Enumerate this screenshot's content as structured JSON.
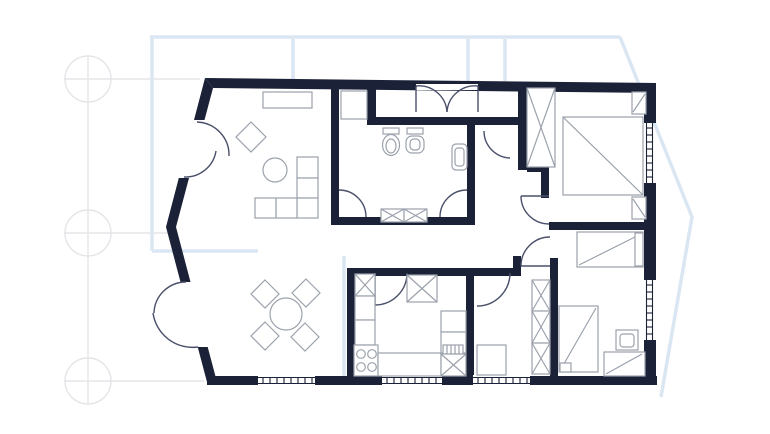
{
  "meta": {
    "type": "floor-plan",
    "description": "apartment blueprint floor plan"
  },
  "colors": {
    "background": "#ffffff",
    "wall": "#1b2137",
    "blueprint": "#dbe6f3",
    "grid": "#e4e5e8",
    "furniture": "#9ba2ac",
    "door": "#4a506a",
    "opening": "#ffffff"
  },
  "layers": {
    "blueprint": [
      {
        "name": "blueprint-outline-top",
        "type": "path",
        "d": "M150,37 H620"
      },
      {
        "name": "blueprint-outline-right-chevron",
        "type": "path",
        "d": "M620,37 L692,217 L661,397"
      },
      {
        "name": "blueprint-outline-left",
        "type": "path",
        "d": "M152,37 V251"
      },
      {
        "name": "blueprint-outline-left-branch",
        "type": "path",
        "d": "M152,251 H258"
      },
      {
        "name": "blueprint-stub-line",
        "type": "path",
        "d": "M293,39 V80"
      },
      {
        "name": "blueprint-stub-line",
        "type": "path",
        "d": "M468,39 V81"
      },
      {
        "name": "blueprint-stub-line",
        "type": "path",
        "d": "M505,39 V81"
      },
      {
        "name": "blueprint-inner-line",
        "type": "path",
        "d": "M344,256 V376"
      }
    ],
    "grid": [
      {
        "name": "grid-marker-circle",
        "type": "circle",
        "cx": 88,
        "cy": 79,
        "r": 23
      },
      {
        "name": "grid-marker-circle",
        "type": "circle",
        "cx": 88,
        "cy": 233,
        "r": 23
      },
      {
        "name": "grid-marker-circle",
        "type": "circle",
        "cx": 88,
        "cy": 381,
        "r": 23
      },
      {
        "name": "grid-axis-vertical",
        "type": "line",
        "x1": 88,
        "y1": 56,
        "x2": 88,
        "y2": 404
      },
      {
        "name": "grid-axis-horizontal",
        "type": "line",
        "x1": 64,
        "y1": 79,
        "x2": 200,
        "y2": 79
      },
      {
        "name": "grid-axis-horizontal",
        "type": "line",
        "x1": 64,
        "y1": 233,
        "x2": 172,
        "y2": 233
      },
      {
        "name": "grid-axis-horizontal",
        "type": "line",
        "x1": 64,
        "y1": 381,
        "x2": 204,
        "y2": 381
      }
    ],
    "walls": [
      {
        "name": "wall-top",
        "type": "poly",
        "points": "205,78 656,83 656,93 213,88"
      },
      {
        "name": "wall-left-upper-a",
        "type": "poly",
        "points": "205,78 213,88 204.5,120 194,120"
      },
      {
        "name": "wall-left-upper-b",
        "type": "poly",
        "points": "178.8,178 189,178 176,227 166,227"
      },
      {
        "name": "wall-left-lower-a",
        "type": "poly",
        "points": "166,227 176,227 190.5,282 180.5,282"
      },
      {
        "name": "wall-left-lower-b",
        "type": "poly",
        "points": "197.7,347 207.7,347 217,382 207,382"
      },
      {
        "name": "wall-bottom",
        "type": "rect",
        "x": 207,
        "y": 376,
        "w": 450,
        "h": 9
      },
      {
        "name": "wall-right-a",
        "type": "rect",
        "x": 644,
        "y": 83,
        "w": 12,
        "h": 40
      },
      {
        "name": "wall-right-b",
        "type": "rect",
        "x": 644,
        "y": 183,
        "w": 12,
        "h": 97
      },
      {
        "name": "wall-right-c",
        "type": "rect",
        "x": 644,
        "y": 340,
        "w": 12,
        "h": 45
      },
      {
        "name": "wall-bath-left",
        "type": "rect",
        "x": 331,
        "y": 86,
        "w": 8,
        "h": 139
      },
      {
        "name": "wall-entry-stub",
        "type": "rect",
        "x": 367,
        "y": 86,
        "w": 9,
        "h": 35
      },
      {
        "name": "wall-closet-bottom",
        "type": "rect",
        "x": 367,
        "y": 117,
        "w": 151,
        "h": 8
      },
      {
        "name": "wall-bath-right",
        "type": "rect",
        "x": 467,
        "y": 125,
        "w": 8,
        "h": 100
      },
      {
        "name": "wall-bath-bottom",
        "type": "rect",
        "x": 331,
        "y": 217,
        "w": 144,
        "h": 8
      },
      {
        "name": "wall-master-left",
        "type": "rect",
        "x": 518,
        "y": 82,
        "w": 9,
        "h": 88
      },
      {
        "name": "wall-master-jog",
        "type": "rect",
        "x": 527,
        "y": 163,
        "w": 22,
        "h": 9
      },
      {
        "name": "wall-master-door-post",
        "type": "rect",
        "x": 541,
        "y": 172,
        "w": 8,
        "h": 26
      },
      {
        "name": "wall-master-south",
        "type": "rect",
        "x": 549,
        "y": 222,
        "w": 107,
        "h": 8
      },
      {
        "name": "wall-bedroom-left",
        "type": "rect",
        "x": 550,
        "y": 258,
        "w": 8,
        "h": 124
      },
      {
        "name": "wall-hall-stub",
        "type": "rect",
        "x": 513,
        "y": 256,
        "w": 8,
        "h": 20
      },
      {
        "name": "wall-midroom-top",
        "type": "rect",
        "x": 474,
        "y": 268,
        "w": 39,
        "h": 8
      },
      {
        "name": "wall-kitchen-top",
        "type": "rect",
        "x": 347,
        "y": 268,
        "w": 119,
        "h": 8
      },
      {
        "name": "wall-kitchen-left",
        "type": "rect",
        "x": 347,
        "y": 268,
        "w": 8,
        "h": 110
      },
      {
        "name": "wall-kitchen-right",
        "type": "rect",
        "x": 466,
        "y": 268,
        "w": 8,
        "h": 110
      }
    ],
    "openings": [
      {
        "name": "door-opening",
        "type": "rect",
        "x": 416,
        "y": 84,
        "w": 62,
        "h": 6
      },
      {
        "name": "window-opening",
        "type": "rect",
        "x": 258,
        "y": 375,
        "w": 57,
        "h": 11
      },
      {
        "name": "window-opening",
        "type": "rect",
        "x": 382,
        "y": 375,
        "w": 60,
        "h": 11
      },
      {
        "name": "window-opening",
        "type": "rect",
        "x": 473,
        "y": 375,
        "w": 57,
        "h": 11
      }
    ],
    "windows": [
      {
        "name": "window",
        "orient": "h",
        "from": 258,
        "to": 315,
        "l1": 377.5,
        "l2": 383.5
      },
      {
        "name": "window",
        "orient": "h",
        "from": 382,
        "to": 442,
        "l1": 377.5,
        "l2": 383.5
      },
      {
        "name": "window",
        "orient": "h",
        "from": 473,
        "to": 530,
        "l1": 377.5,
        "l2": 383.5
      },
      {
        "name": "window",
        "orient": "v",
        "from": 123,
        "to": 183,
        "l1": 646.5,
        "l2": 652.5
      },
      {
        "name": "window",
        "orient": "v",
        "from": 280,
        "to": 340,
        "l1": 646.5,
        "l2": 652.5
      }
    ],
    "doors": [
      {
        "name": "closet-door-leaf",
        "type": "line",
        "x1": 416,
        "y1": 86,
        "x2": 416,
        "y2": 112
      },
      {
        "name": "closet-door-leaf",
        "type": "line",
        "x1": 478,
        "y1": 86,
        "x2": 478,
        "y2": 112
      },
      {
        "name": "closet-door-swing",
        "type": "path",
        "d": "M416,86 A28,28 0 0 1 447,112"
      },
      {
        "name": "closet-door-swing",
        "type": "path",
        "d": "M478,86 A28,28 0 0 0 447,112"
      },
      {
        "name": "balcony-door-swing",
        "type": "path",
        "d": "M197,122 A33,33 0 0 1 229,156"
      },
      {
        "name": "balcony-door-swing",
        "type": "path",
        "d": "M184,177 A31,31 0 0 0 216,151"
      },
      {
        "name": "terrace-door-swing",
        "type": "path",
        "d": "M186,282 A32,32 0 0 0 154,313"
      },
      {
        "name": "terrace-door-swing",
        "type": "path",
        "d": "M198,347 A40,40 0 0 1 153,313"
      },
      {
        "name": "bathroom-door-swing",
        "type": "path",
        "d": "M339,190 A27,27 0 0 1 366,217"
      },
      {
        "name": "bathroom-door-swing",
        "type": "path",
        "d": "M440,217 A27,27 0 0 1 467,190"
      },
      {
        "name": "hall-door-swing",
        "type": "path",
        "d": "M484,131 A27,27 0 0 0 510,158"
      },
      {
        "name": "master-door-leaf",
        "type": "line",
        "x1": 521,
        "y1": 196,
        "x2": 549,
        "y2": 196
      },
      {
        "name": "master-door-swing",
        "type": "path",
        "d": "M521,196 A28,28 0 0 0 549,224"
      },
      {
        "name": "bedroom-door-leaf",
        "type": "line",
        "x1": 521,
        "y1": 266,
        "x2": 550,
        "y2": 266
      },
      {
        "name": "bedroom-door-swing",
        "type": "path",
        "d": "M521,266 A29,29 0 0 1 550,237"
      },
      {
        "name": "midroom-door-swing",
        "type": "path",
        "d": "M510,273 A33,33 0 0 1 477,306"
      },
      {
        "name": "kitchen-door-leaf",
        "type": "line",
        "x1": 375,
        "y1": 273,
        "x2": 375,
        "y2": 305
      },
      {
        "name": "kitchen-door-swing",
        "type": "path",
        "d": "M375,305 A32,32 0 0 0 407,273"
      }
    ],
    "furniture": [
      {
        "name": "sideboard",
        "type": "rect",
        "x": 263,
        "y": 92,
        "w": 49,
        "h": 16
      },
      {
        "name": "armchair",
        "type": "poly",
        "points": "251,122 266,137 251,152 236,137"
      },
      {
        "name": "side-table",
        "type": "circle",
        "cx": 275,
        "cy": 170,
        "r": 12
      },
      {
        "name": "sofa-seat",
        "type": "rect",
        "x": 297,
        "y": 157,
        "w": 21,
        "h": 21
      },
      {
        "name": "sofa-seat",
        "type": "rect",
        "x": 297,
        "y": 178,
        "w": 21,
        "h": 20
      },
      {
        "name": "sofa-seat",
        "type": "rect",
        "x": 297,
        "y": 198,
        "w": 21,
        "h": 20
      },
      {
        "name": "sofa-seat",
        "type": "rect",
        "x": 276,
        "y": 198,
        "w": 21,
        "h": 20
      },
      {
        "name": "sofa-seat",
        "type": "rect",
        "x": 255,
        "y": 198,
        "w": 21,
        "h": 20
      },
      {
        "name": "dining-table",
        "type": "circle",
        "cx": 286,
        "cy": 314,
        "r": 16
      },
      {
        "name": "dining-chair",
        "type": "poly",
        "points": "265,280 279,294 265,308 251,294"
      },
      {
        "name": "dining-chair",
        "type": "poly",
        "points": "306,279 320,293 306,307 292,293"
      },
      {
        "name": "dining-chair",
        "type": "poly",
        "points": "265,322 279,336 265,350 251,336"
      },
      {
        "name": "dining-chair",
        "type": "poly",
        "points": "305,323 319,337 305,351 291,337"
      },
      {
        "name": "washing-machine",
        "type": "rect",
        "x": 341,
        "y": 91,
        "w": 26,
        "h": 28
      },
      {
        "name": "toilet-tank",
        "type": "rect",
        "x": 383,
        "y": 128,
        "w": 16,
        "h": 6
      },
      {
        "name": "toilet-bowl",
        "type": "ellipse",
        "cx": 391,
        "cy": 145,
        "rx": 8.5,
        "ry": 10.5
      },
      {
        "name": "toilet-bowl-inner",
        "type": "ellipse",
        "cx": 391,
        "cy": 146,
        "rx": 5,
        "ry": 7
      },
      {
        "name": "bidet-tank",
        "type": "rect",
        "x": 407,
        "y": 128,
        "w": 16,
        "h": 6
      },
      {
        "name": "bidet-bowl",
        "type": "rect",
        "x": 406,
        "y": 136,
        "w": 18,
        "h": 17,
        "rx": 6
      },
      {
        "name": "bidet-bowl-inner",
        "type": "rect",
        "x": 410,
        "y": 139,
        "w": 10,
        "h": 11,
        "rx": 4
      },
      {
        "name": "wall-sink",
        "type": "rect",
        "x": 452,
        "y": 144,
        "w": 15,
        "h": 26,
        "rx": 4
      },
      {
        "name": "wall-sink-inner",
        "type": "rect",
        "x": 455,
        "y": 148,
        "w": 9,
        "h": 18,
        "rx": 3
      },
      {
        "name": "radiator",
        "type": "xrect",
        "x": 381,
        "y": 209,
        "w": 23,
        "h": 13
      },
      {
        "name": "radiator",
        "type": "xrect",
        "x": 404,
        "y": 209,
        "w": 23,
        "h": 13
      },
      {
        "name": "kitchen-cabinet-x",
        "type": "xrect",
        "x": 355,
        "y": 274,
        "w": 20,
        "h": 22
      },
      {
        "name": "kitchen-cabinet-x",
        "type": "xrect",
        "x": 407,
        "y": 275,
        "w": 30,
        "h": 27
      },
      {
        "name": "kitchen-counter",
        "type": "rect",
        "x": 355,
        "y": 296,
        "w": 20,
        "h": 24
      },
      {
        "name": "kitchen-counter",
        "type": "rect",
        "x": 355,
        "y": 320,
        "w": 20,
        "h": 25
      },
      {
        "name": "stove",
        "type": "rect",
        "x": 354,
        "y": 345,
        "w": 24,
        "h": 31
      },
      {
        "name": "stove-burner",
        "type": "circle",
        "cx": 361,
        "cy": 354,
        "r": 4.3
      },
      {
        "name": "stove-burner",
        "type": "circle",
        "cx": 372,
        "cy": 354,
        "r": 4.3
      },
      {
        "name": "stove-burner",
        "type": "circle",
        "cx": 361,
        "cy": 367,
        "r": 4.3
      },
      {
        "name": "stove-burner",
        "type": "circle",
        "cx": 372,
        "cy": 367,
        "r": 4.3
      },
      {
        "name": "kitchen-counter",
        "type": "rect",
        "x": 378,
        "y": 353,
        "w": 63,
        "h": 23
      },
      {
        "name": "kitchen-unit",
        "type": "rect",
        "x": 441,
        "y": 311,
        "w": 25,
        "h": 21
      },
      {
        "name": "kitchen-sink-unit",
        "type": "rect",
        "x": 441,
        "y": 332,
        "w": 25,
        "h": 21
      },
      {
        "name": "sink-drainer",
        "type": "hatch",
        "x": 443,
        "y": 345,
        "w": 20,
        "h": 9,
        "step": 4
      },
      {
        "name": "kitchen-cabinet-x",
        "type": "xrect",
        "x": 441,
        "y": 354,
        "w": 25,
        "h": 22
      },
      {
        "name": "wardrobe",
        "type": "xrect",
        "x": 527,
        "y": 88,
        "w": 28,
        "h": 79
      },
      {
        "name": "double-bed",
        "type": "rect",
        "x": 563,
        "y": 117,
        "w": 80,
        "h": 78
      },
      {
        "name": "double-bed-diagonal",
        "type": "line",
        "x1": 563,
        "y1": 117,
        "x2": 643,
        "y2": 195
      },
      {
        "name": "nightstand",
        "type": "rect",
        "x": 632,
        "y": 92,
        "w": 14,
        "h": 22
      },
      {
        "name": "nightstand-flap",
        "type": "line",
        "x1": 633,
        "y1": 112,
        "x2": 645,
        "y2": 94
      },
      {
        "name": "nightstand",
        "type": "rect",
        "x": 632,
        "y": 197,
        "w": 14,
        "h": 22
      },
      {
        "name": "nightstand-flap",
        "type": "line",
        "x1": 633,
        "y1": 199,
        "x2": 645,
        "y2": 217
      },
      {
        "name": "single-bed",
        "type": "rect",
        "x": 577,
        "y": 232,
        "w": 66,
        "h": 35
      },
      {
        "name": "single-bed-diagonal",
        "type": "line",
        "x1": 579,
        "y1": 265,
        "x2": 641,
        "y2": 234
      },
      {
        "name": "bed-pillow",
        "type": "rect",
        "x": 635,
        "y": 233,
        "w": 8,
        "h": 33
      },
      {
        "name": "single-bed",
        "type": "rect",
        "x": 559,
        "y": 306,
        "w": 39,
        "h": 66
      },
      {
        "name": "single-bed-diagonal",
        "type": "line",
        "x1": 596,
        "y1": 308,
        "x2": 561,
        "y2": 369
      },
      {
        "name": "bed-pillow",
        "type": "rect",
        "x": 560,
        "y": 363,
        "w": 11,
        "h": 9
      },
      {
        "name": "bedside-table",
        "type": "rect",
        "x": 616,
        "y": 330,
        "w": 22,
        "h": 20
      },
      {
        "name": "bedside-table-inner",
        "type": "rect",
        "x": 620,
        "y": 334,
        "w": 14,
        "h": 13,
        "rx": 3
      },
      {
        "name": "desk",
        "type": "rect",
        "x": 604,
        "y": 352,
        "w": 41,
        "h": 24
      },
      {
        "name": "desk-diagonal",
        "type": "line",
        "x1": 606,
        "y1": 374,
        "x2": 642,
        "y2": 354
      },
      {
        "name": "wardrobe",
        "type": "xrect",
        "x": 532,
        "y": 280,
        "w": 18,
        "h": 31
      },
      {
        "name": "wardrobe",
        "type": "xrect",
        "x": 532,
        "y": 311,
        "w": 18,
        "h": 32
      },
      {
        "name": "wardrobe",
        "type": "xrect",
        "x": 532,
        "y": 343,
        "w": 18,
        "h": 31
      },
      {
        "name": "dresser",
        "type": "rect",
        "x": 477,
        "y": 345,
        "w": 29,
        "h": 30
      }
    ]
  }
}
